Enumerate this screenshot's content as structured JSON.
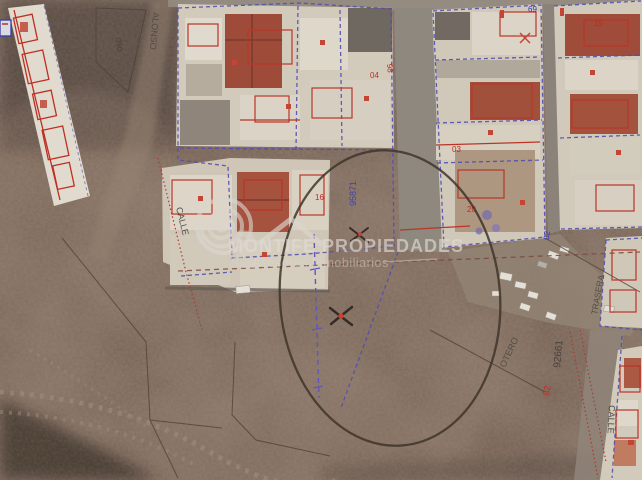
{
  "image_type": "aerial-cadastral-photo",
  "watermark": {
    "brand": "MONTIFE PROPIEDADES",
    "tagline": "Asesores Inmobiliarios",
    "numeral": "2",
    "logo": "spiral-circle-and-house-roof",
    "color": "#e8e4de"
  },
  "labels": [
    {
      "id": "street-calle-west",
      "text": "CALLE"
    },
    {
      "id": "street-calle-south",
      "text": "CALLE"
    },
    {
      "id": "street-alonso",
      "text": "ALONSO"
    },
    {
      "id": "street-otero",
      "text": "OTERO"
    },
    {
      "id": "street-trasera",
      "text": "TRASERA"
    },
    {
      "id": "parcel-95871",
      "text": "95871"
    },
    {
      "id": "parcel-92661",
      "text": "92661"
    },
    {
      "id": "parcel-090",
      "text": "090"
    },
    {
      "id": "num-69",
      "text": "69"
    },
    {
      "id": "num-04",
      "text": "04"
    },
    {
      "id": "num-03",
      "text": "03"
    },
    {
      "id": "num-02",
      "text": "02"
    },
    {
      "id": "num-16",
      "text": "16"
    },
    {
      "id": "num-98",
      "text": "98"
    },
    {
      "id": "num-82",
      "text": "82"
    },
    {
      "id": "num-19",
      "text": "19"
    },
    {
      "id": "num-20",
      "text": "20"
    }
  ],
  "annotations": {
    "plot_circle": {
      "type": "hand-drawn-circle",
      "cx": 390,
      "cy": 298,
      "rx": 110,
      "ry": 148,
      "color": "#362a20"
    },
    "x_marks": [
      {
        "x": 341,
        "y": 316,
        "center_dot_color": "#e03322"
      },
      {
        "x": 359,
        "y": 234,
        "center_dot_color": "#d13b2a"
      }
    ]
  },
  "palette": {
    "terrain_dark": "#4e3c34",
    "terrain_mid": "#75594c",
    "terrain_light": "#9a8470",
    "road_grey": "#8f877d",
    "building_white": "#e4ddcf",
    "building_roof_red": "#a5432f",
    "cadastral_blue": "#4b46c0",
    "cadastral_red": "#c8281a",
    "dashed_brown": "#7e4034"
  }
}
